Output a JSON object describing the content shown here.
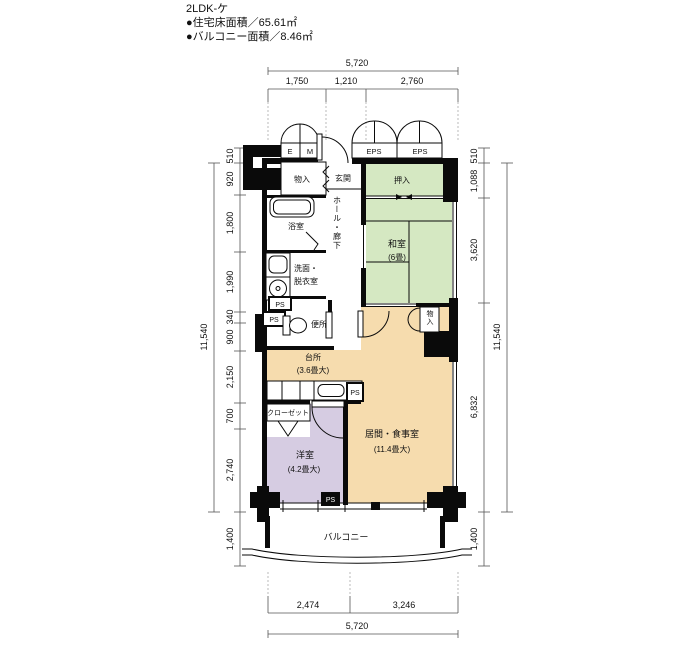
{
  "header": {
    "title": "2LDK-ケ",
    "floor_area": "●住宅床面積／65.61㎡",
    "balcony_area": "●バルコニー面積／8.46㎡"
  },
  "dimensions": {
    "top": {
      "total": "5,720",
      "segments": [
        "1,750",
        "1,210",
        "2,760"
      ]
    },
    "bottom": {
      "total": "5,720",
      "segments": [
        "2,474",
        "3,246"
      ]
    },
    "left": {
      "overall": "11,540",
      "segments": [
        "510",
        "920",
        "1,800",
        "1,990",
        "340",
        "900",
        "2,150",
        "700",
        "2,740"
      ],
      "balcony": "1,400"
    },
    "right": {
      "overall": "11,540",
      "segments": [
        "510",
        "1,088",
        "3,620",
        "6,832"
      ],
      "balcony": "1,400"
    }
  },
  "labels": {
    "e": "E",
    "m": "M",
    "eps": "EPS",
    "ps": "PS",
    "storage": "物入",
    "entrance": "玄関",
    "oshiire": "押入",
    "bath": "浴室",
    "hall": "ホール・廊下",
    "wash1": "洗面・",
    "wash2": "脱衣室",
    "toilet": "便所",
    "kitchen": "台所",
    "kitchen_size": "(3.6畳大)",
    "washitsu": "和室",
    "washitsu_size": "(6畳)",
    "closet": "クローゼット",
    "western": "洋室",
    "western_size": "(4.2畳大)",
    "living": "居間・食事室",
    "living_size": "(11.4畳大)",
    "balcony": "バルコニー"
  },
  "colors": {
    "wall": "#0a0a0a",
    "tatami_green": "#d5e8c2",
    "wood_orange": "#f6dcae",
    "western_purple": "#d6cce2",
    "background": "#ffffff"
  }
}
